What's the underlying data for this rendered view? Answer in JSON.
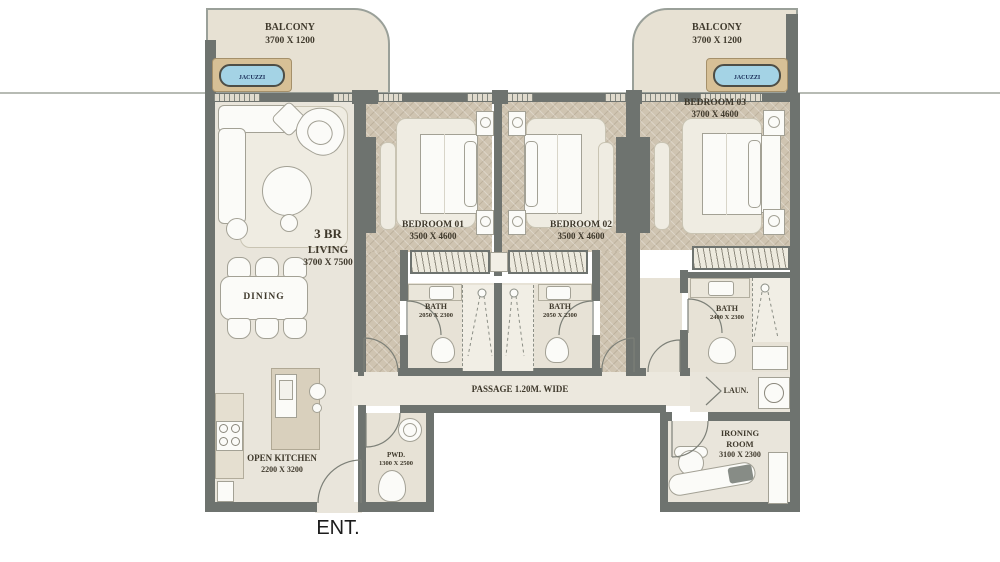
{
  "entrance": {
    "label": "ENT."
  },
  "balcony_left": {
    "title": "BALCONY",
    "dims": "3700 X 1200",
    "jacuzzi": "JACUZZI"
  },
  "balcony_right": {
    "title": "BALCONY",
    "dims": "3700 X 1200",
    "jacuzzi": "JACUZZI"
  },
  "living": {
    "type": "3 BR",
    "title": "LIVING",
    "dims": "3700 X 7500"
  },
  "dining": {
    "title": "DINING"
  },
  "kitchen": {
    "title": "OPEN KITCHEN",
    "dims": "2200 X 3200"
  },
  "bedroom_01": {
    "title": "BEDROOM 01",
    "dims": "3500 X 4600"
  },
  "bedroom_02": {
    "title": "BEDROOM 02",
    "dims": "3500 X 4600"
  },
  "bedroom_03": {
    "title": "BEDROOM 03",
    "dims": "3700 X 4600"
  },
  "bath_01": {
    "title": "BATH",
    "dims": "2050 X 2300"
  },
  "bath_02": {
    "title": "BATH",
    "dims": "2050 X 2300"
  },
  "bath_03": {
    "title": "BATH",
    "dims": "2400 X 2300"
  },
  "passage": {
    "title": "PASSAGE 1.20M. WIDE"
  },
  "pwd": {
    "title": "PWD.",
    "dims": "1300 X 2500"
  },
  "laundry": {
    "title": "LAUN."
  },
  "ironing": {
    "title": "IRONING",
    "title2": "ROOM",
    "dims": "3100 X 2300"
  },
  "colors": {
    "wall": "#6e736f",
    "wood_floor": "#cfc4b1",
    "tile_floor": "#e9e5db",
    "balcony_floor": "#e7e1d3",
    "jacuzzi_water": "#a4d3e5",
    "jacuzzi_frame": "#d7c096",
    "label_text": "#3f392c"
  }
}
